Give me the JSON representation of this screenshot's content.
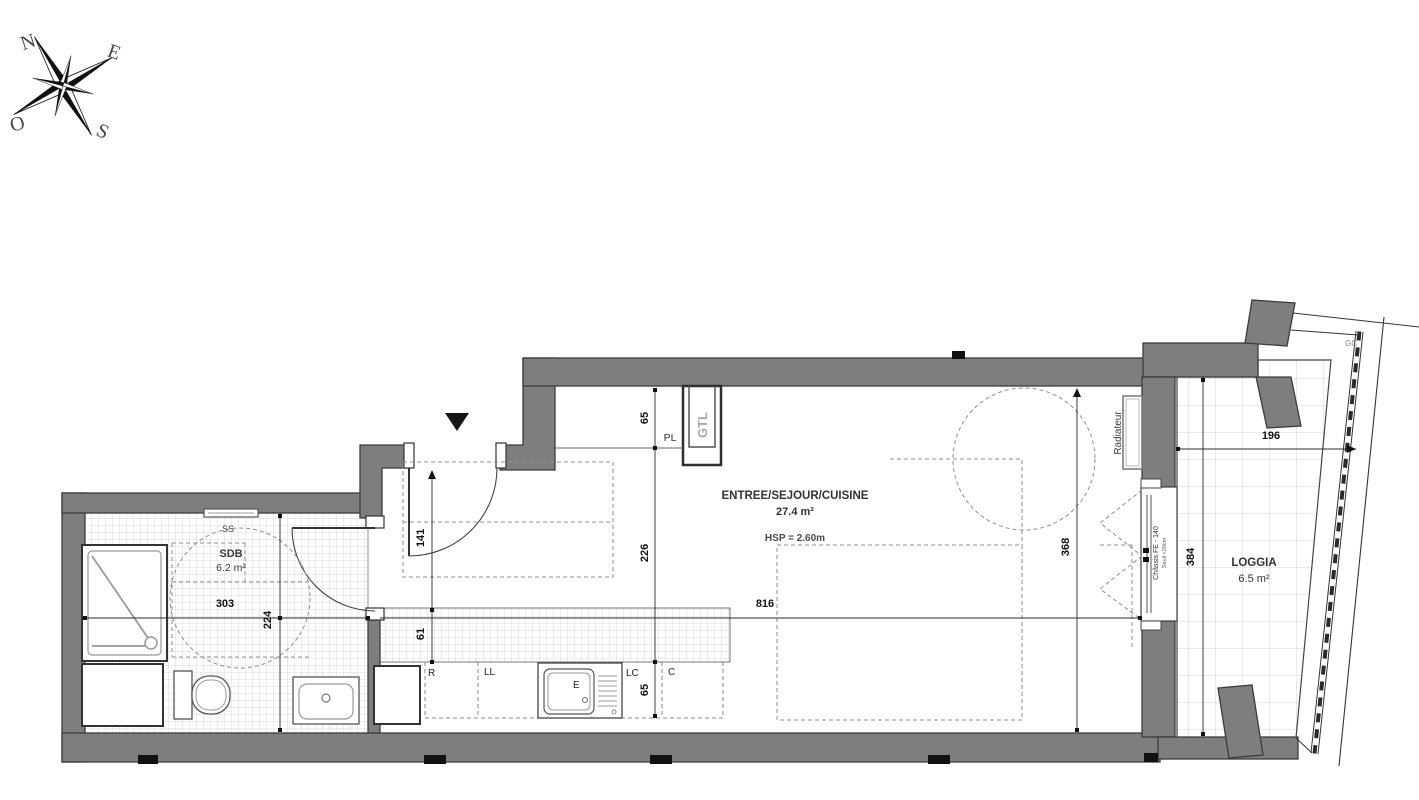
{
  "colors": {
    "wall": "#7e7e7e",
    "wall_outline": "#3c3c3c",
    "tile_line": "#cfcfcf",
    "loggia_tile_line": "#d4d4d4",
    "dashed": "#909090",
    "dimension": "#1a1a1a",
    "label": "#333333",
    "muted": "#a8a8a8"
  },
  "compass": {
    "north": "N",
    "east": "E",
    "south": "S",
    "west": "O"
  },
  "rooms": {
    "main": {
      "name": "ENTREE/SEJOUR/CUISINE",
      "area": "27.4 m²",
      "ceiling": "HSP = 2.60m"
    },
    "bathroom": {
      "name": "SDB",
      "area": "6.2 m²"
    },
    "loggia": {
      "name": "LOGGIA",
      "area": "6.5 m²"
    }
  },
  "labels": {
    "towel_rail": "SS",
    "placard": "PL",
    "gtl_duct": "GTL",
    "radiator": "Radiateur",
    "window": "Châssis FE - 140",
    "window_note": "Seuil <20cm",
    "gc": "GC",
    "fridge": "R",
    "washing_machine": "LL",
    "sink": "E",
    "unit_lc": "LC",
    "unit_c": "C"
  },
  "dims": {
    "bathroom_width": "303",
    "bathroom_depth": "224",
    "entry_width": "141",
    "backsplash_depth": "61",
    "placard_depth": "65",
    "kitchen_depth": "226",
    "counter_depth": "65",
    "living_length": "816",
    "living_depth": "368",
    "loggia_length": "384",
    "loggia_depth": "196"
  }
}
